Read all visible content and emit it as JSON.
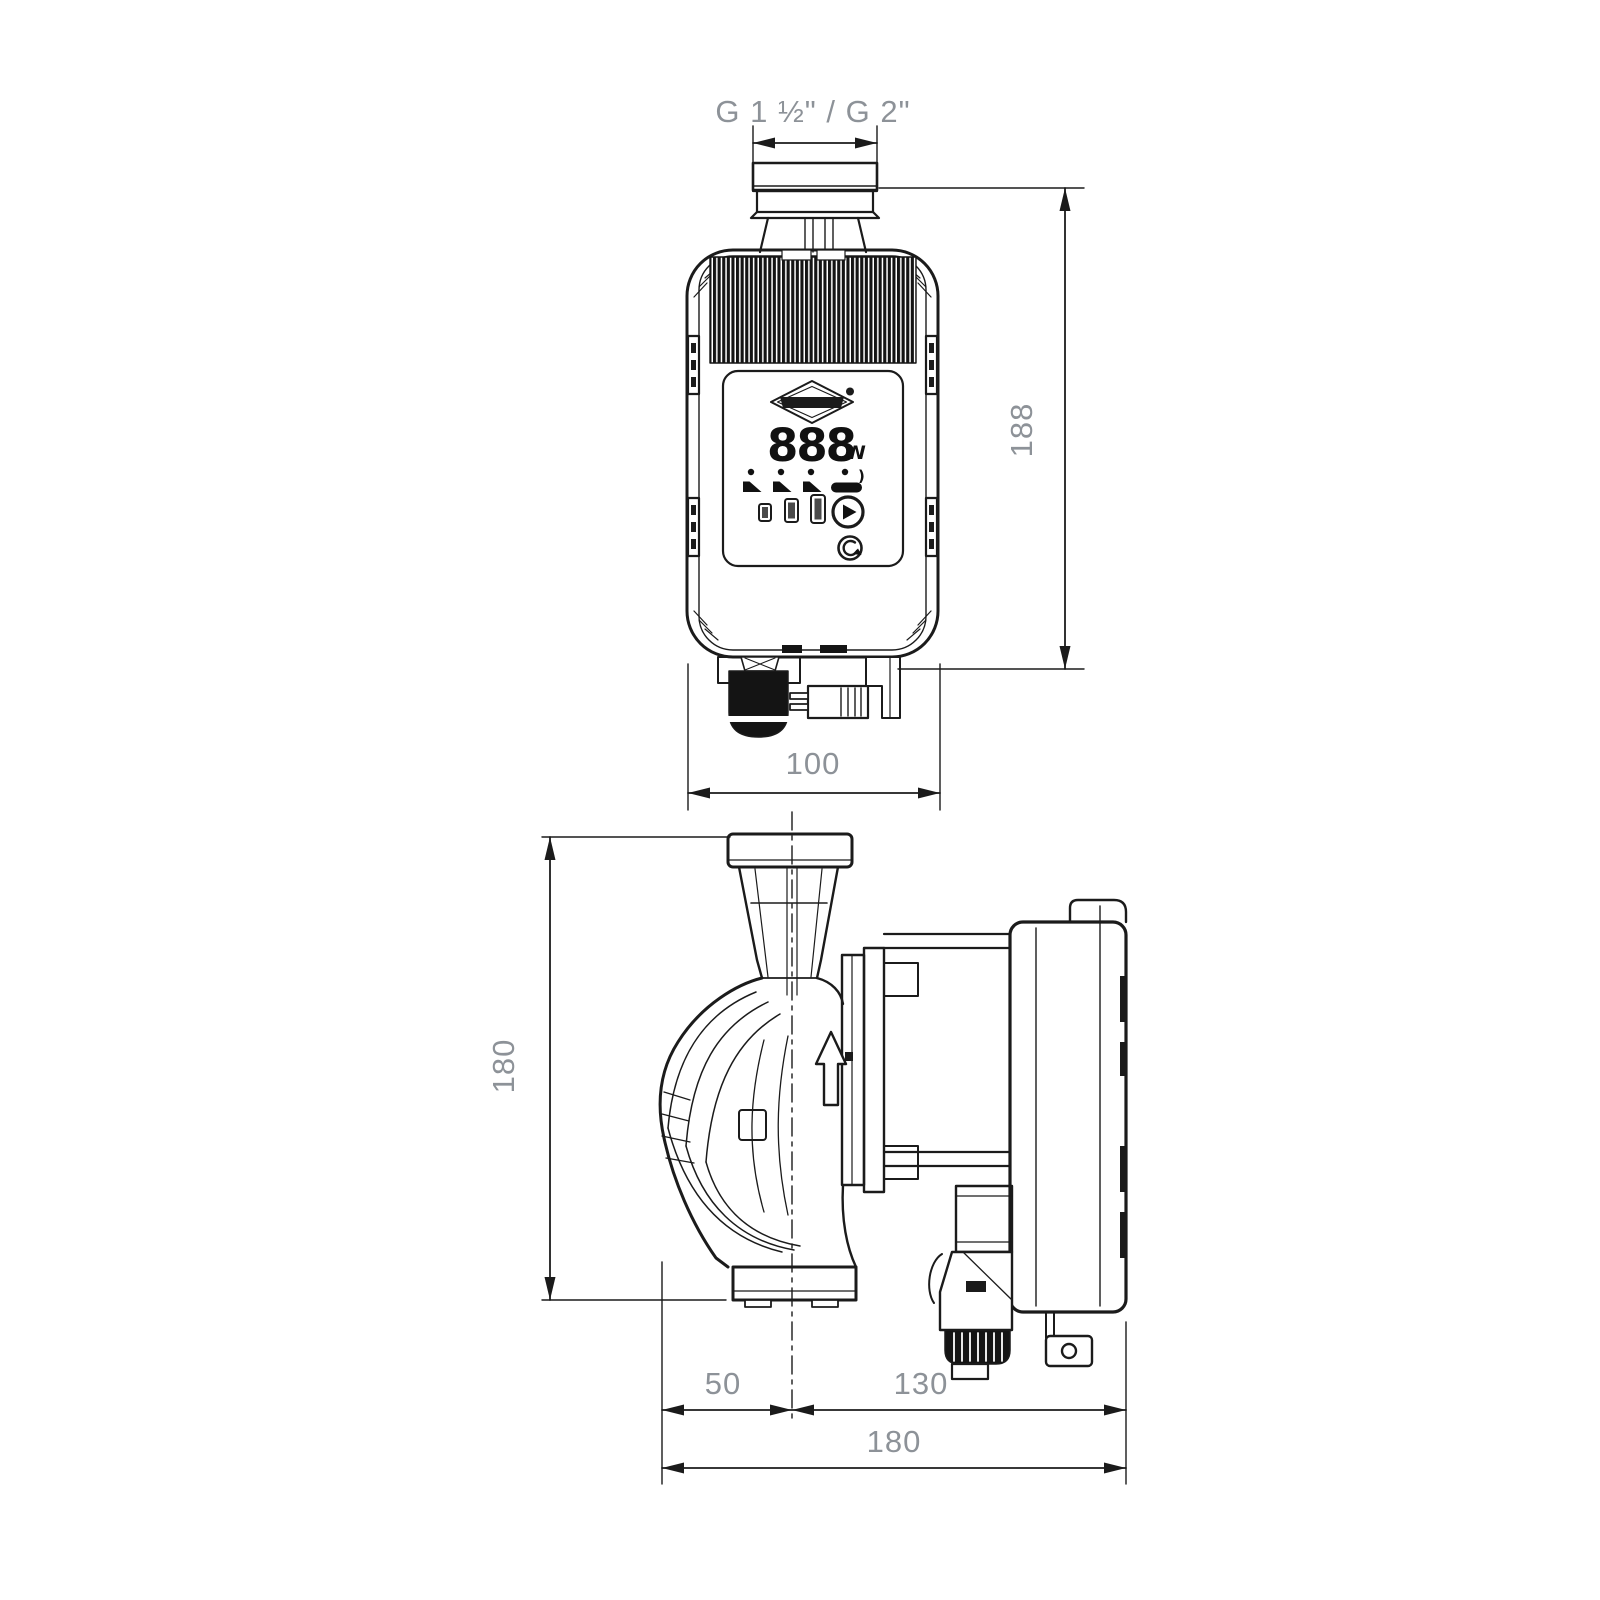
{
  "page": {
    "description": "Dimensional line drawing of an electronic circulation pump, front and side orthographic views with millimetre dimensions",
    "background": "#ffffff"
  },
  "front_view": {
    "thread_label": "G 1 ½\" / G 2\"",
    "height_dim": "188",
    "width_dim": "100",
    "display": {
      "power_value": "888",
      "power_unit": "W",
      "mode_mark": ")",
      "icons": [
        "brand-diamond-logo",
        "registered-mark-dot",
        "mode-icon-1",
        "mode-icon-2",
        "mode-icon-3",
        "auto-mode-icon",
        "level-bar-small",
        "level-bar-medium",
        "level-bar-large",
        "play-button",
        "reset-button"
      ]
    }
  },
  "side_view": {
    "height_dim": "180",
    "center_to_left_dim": "50",
    "center_to_right_dim": "130",
    "total_length_dim": "180",
    "flow_direction_icon": "up-arrow"
  },
  "colors": {
    "line": "#1b1b1b",
    "dim_text": "#8d9298",
    "band_fill": "#141414"
  }
}
